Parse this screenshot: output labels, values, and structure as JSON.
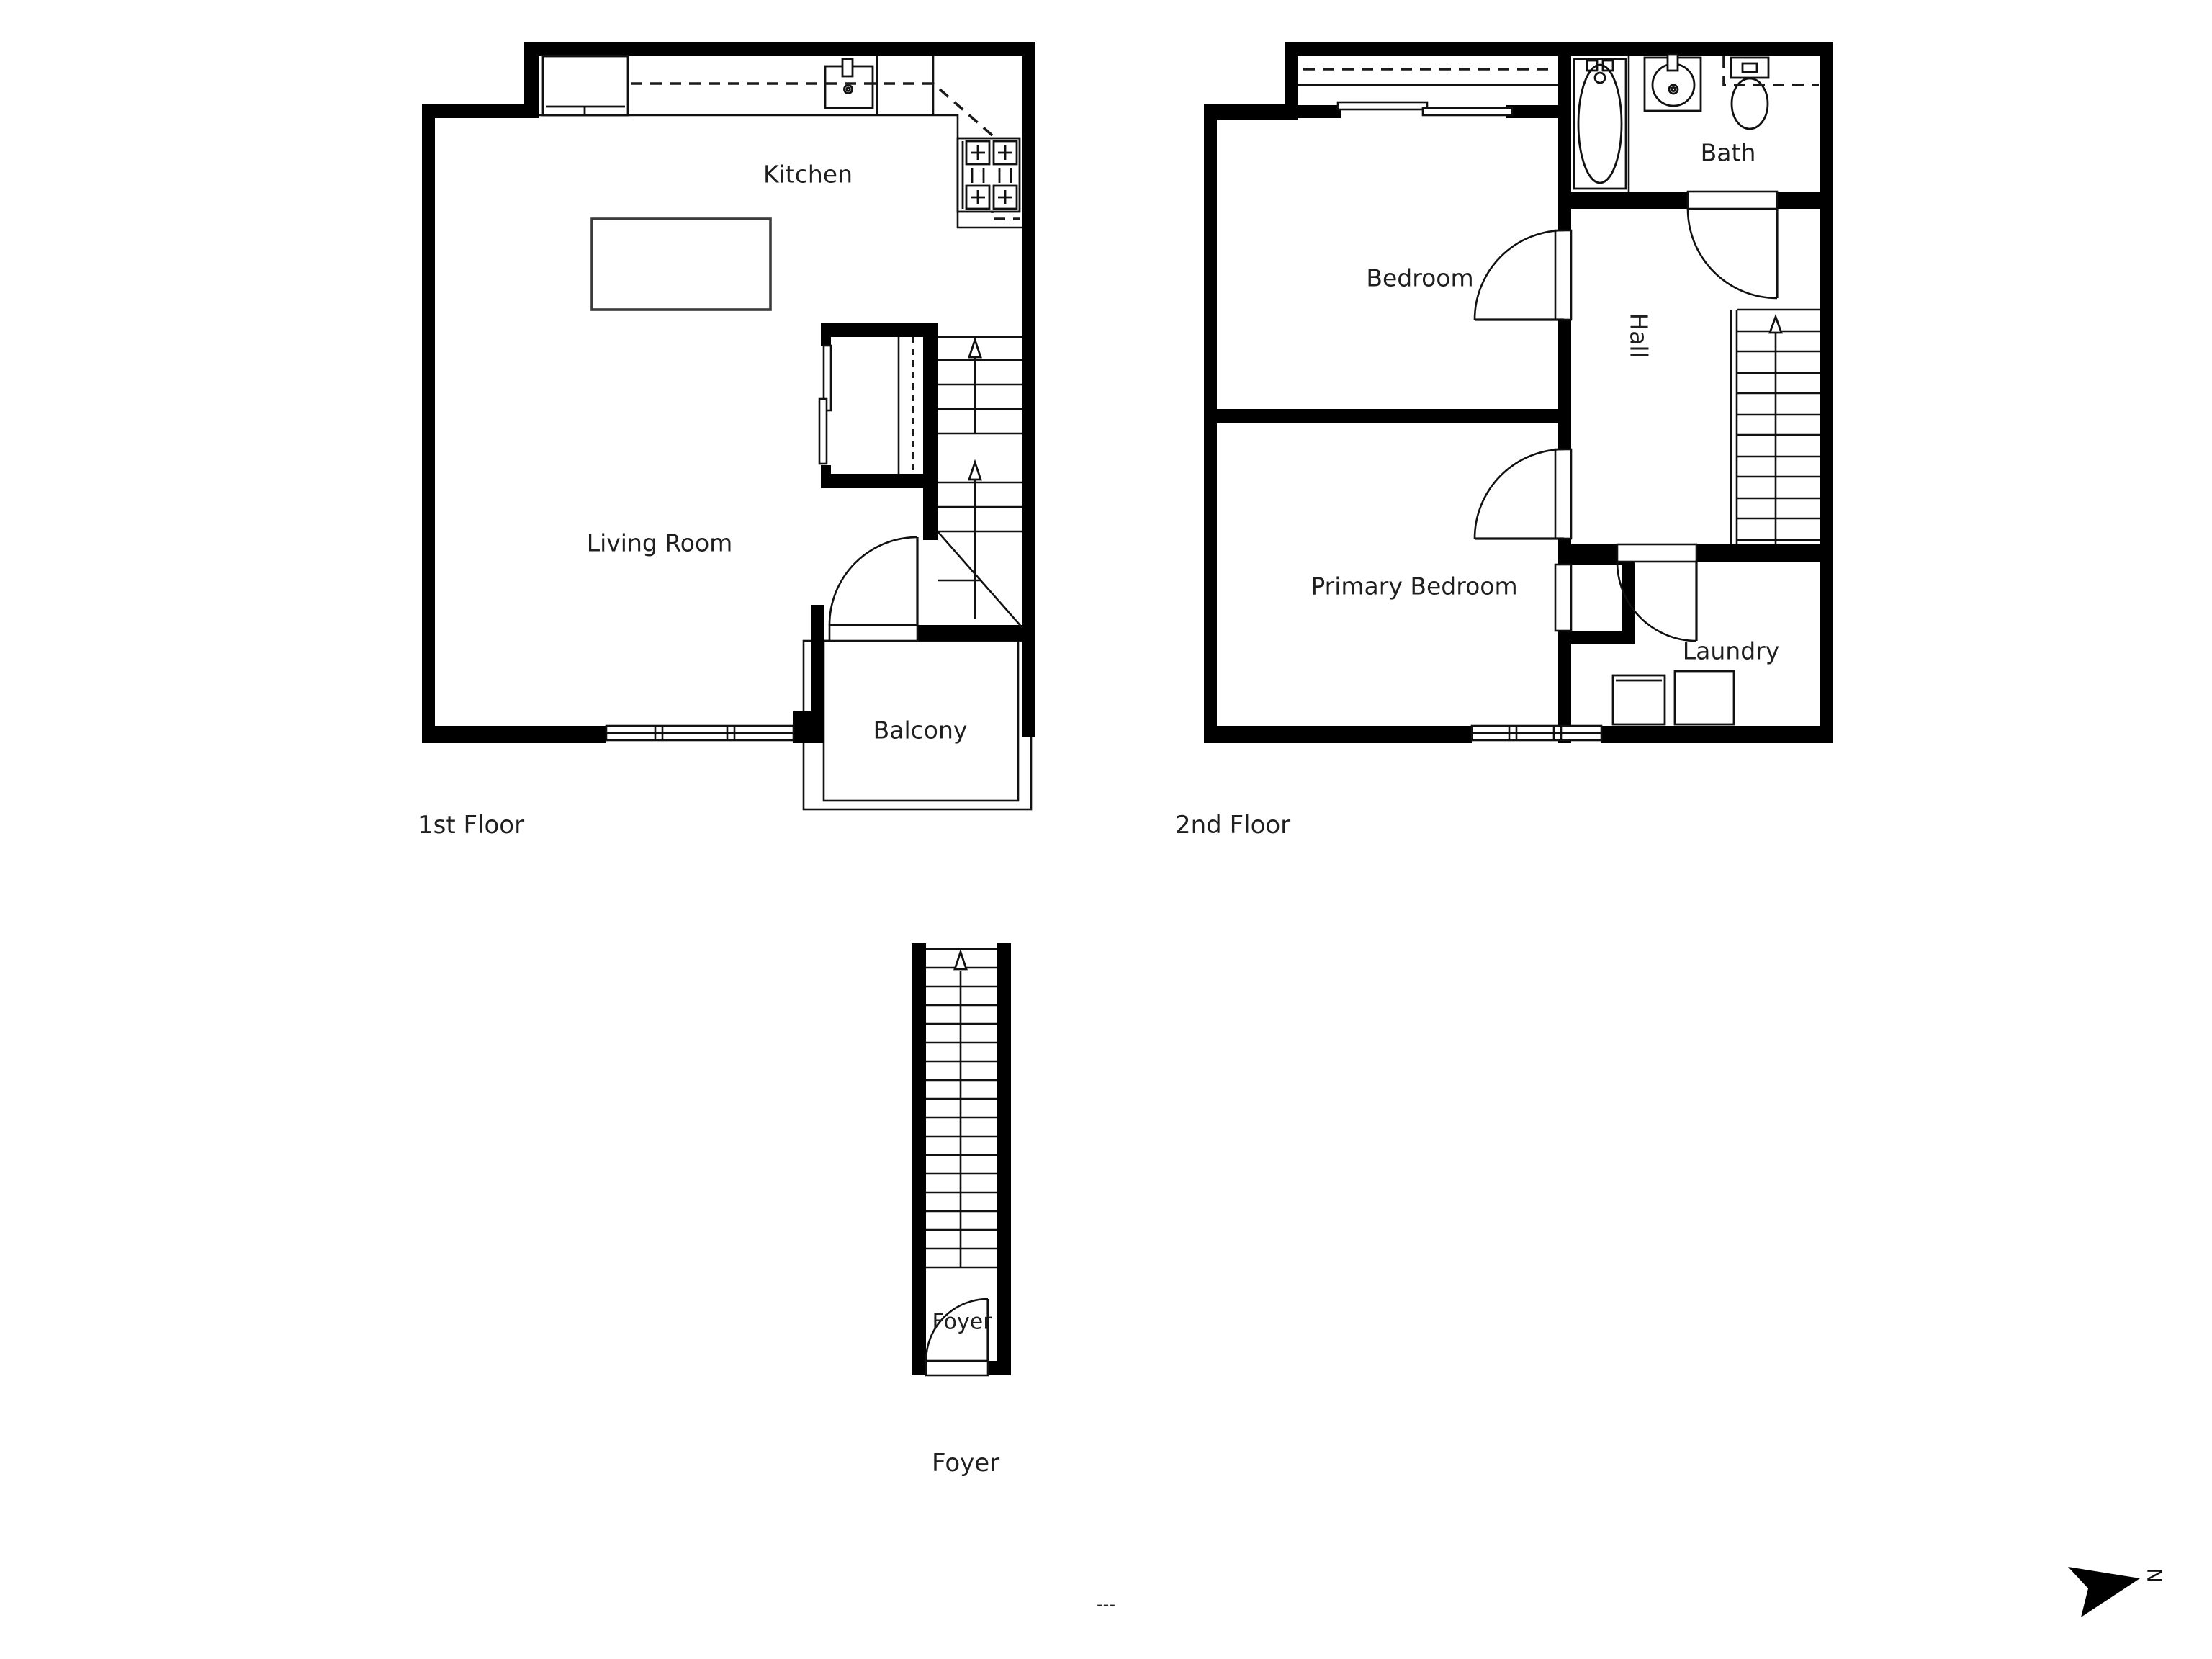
{
  "page": {
    "background": "#ffffff",
    "footer_text": "---",
    "line_color": "#111111",
    "wall_color": "#000000"
  },
  "compass": {
    "label": "N"
  },
  "floors": {
    "first": {
      "caption": "1st Floor",
      "rooms": {
        "kitchen": "Kitchen",
        "living_room": "Living Room",
        "balcony": "Balcony"
      }
    },
    "second": {
      "caption": "2nd Floor",
      "rooms": {
        "bedroom": "Bedroom",
        "bath": "Bath",
        "hall": "Hall",
        "primary_bedroom": "Primary Bedroom",
        "laundry": "Laundry"
      }
    },
    "foyer": {
      "caption": "Foyer",
      "rooms": {
        "foyer": "Foyer"
      }
    }
  }
}
